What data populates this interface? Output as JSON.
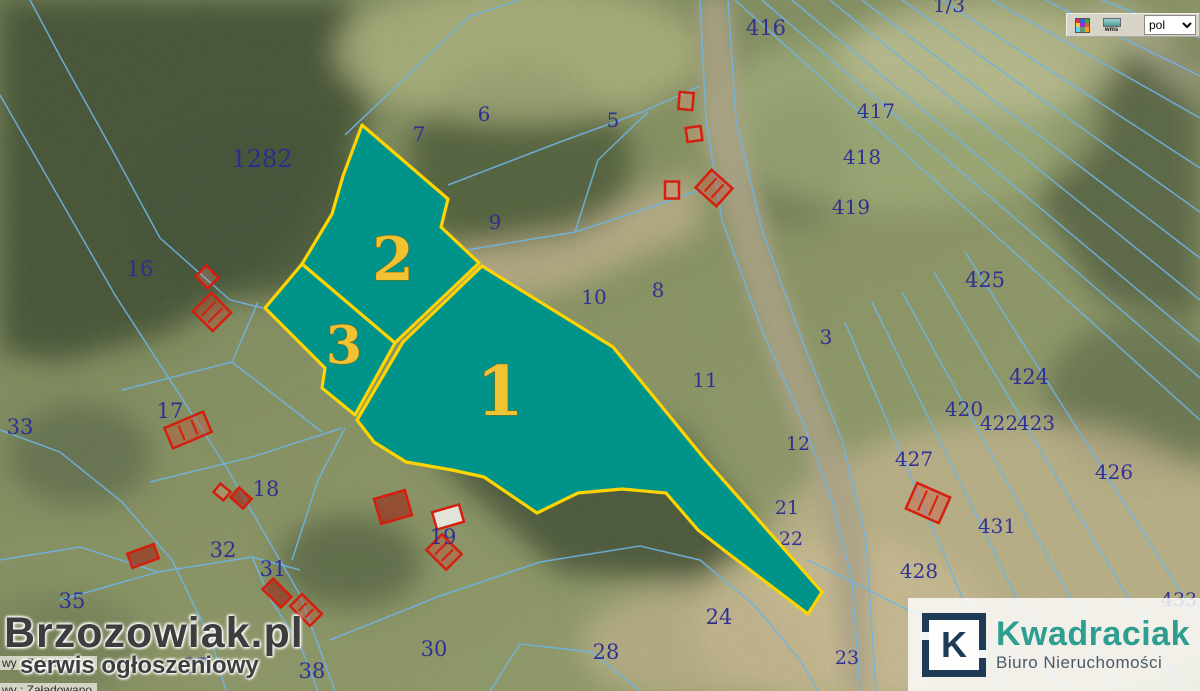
{
  "toolbar": {
    "legend_icon": "legend-grid-icon",
    "wms_icon": "wms-layers-icon",
    "wms_label": "wms",
    "language_value": "pol"
  },
  "watermark": {
    "site": "Brzozowiak.pl",
    "tagline": "serwis ogłoszeniowy"
  },
  "agency": {
    "initial": "K",
    "name": "Kwadraciak",
    "subtitle": "Biuro Nieruchomości"
  },
  "status_messages": [
    "wy : Załadowano",
    "wy : Załadowano"
  ],
  "colors": {
    "parcel_fill": "#00938a",
    "parcel_border": "#ffd400",
    "parcel_label": "#f1c232",
    "parcel_number": "#2b2b94",
    "cadastral_line": "#6fb4e4",
    "building_outline": "#d41f0f",
    "agency_navy": "#1d3a57",
    "agency_teal": "#2d9e8f"
  },
  "map": {
    "highlighted_parcels": [
      {
        "label": "1",
        "points": "482,266 613,347 703,457 822,592 808,614 725,551 698,530 666,493 622,489 578,493 537,513 484,477 452,470 406,462 374,442 357,420 403,342",
        "lx": 500,
        "ly": 392,
        "ls": 68
      },
      {
        "label": "2",
        "points": "362,125 448,199 441,227 479,263 399,339 395,343 302,264 332,214 343,176",
        "lx": 393,
        "ly": 260,
        "ls": 60
      },
      {
        "label": "3",
        "points": "265,308 302,264 395,343 355,415 322,388 325,368",
        "lx": 344,
        "ly": 346,
        "ls": 52
      }
    ],
    "parcel_numbers": [
      {
        "text": "1282",
        "x": 262,
        "y": 167,
        "s": 24
      },
      {
        "text": "16",
        "x": 140,
        "y": 276,
        "s": 21
      },
      {
        "text": "33",
        "x": 20,
        "y": 434,
        "s": 21
      },
      {
        "text": "17",
        "x": 170,
        "y": 418,
        "s": 21
      },
      {
        "text": "18",
        "x": 266,
        "y": 496,
        "s": 21
      },
      {
        "text": "32",
        "x": 223,
        "y": 557,
        "s": 21
      },
      {
        "text": "31",
        "x": 273,
        "y": 576,
        "s": 21
      },
      {
        "text": "35",
        "x": 72,
        "y": 608,
        "s": 21
      },
      {
        "text": "37",
        "x": 196,
        "y": 673,
        "s": 21
      },
      {
        "text": "38",
        "x": 312,
        "y": 678,
        "s": 21
      },
      {
        "text": "30",
        "x": 434,
        "y": 656,
        "s": 21
      },
      {
        "text": "19",
        "x": 443,
        "y": 544,
        "s": 21
      },
      {
        "text": "28",
        "x": 606,
        "y": 659,
        "s": 21
      },
      {
        "text": "24",
        "x": 719,
        "y": 624,
        "s": 21
      },
      {
        "text": "23",
        "x": 847,
        "y": 664,
        "s": 19
      },
      {
        "text": "7",
        "x": 419,
        "y": 141,
        "s": 20
      },
      {
        "text": "6",
        "x": 484,
        "y": 121,
        "s": 20
      },
      {
        "text": "5",
        "x": 613,
        "y": 127,
        "s": 20
      },
      {
        "text": "9",
        "x": 495,
        "y": 229,
        "s": 20
      },
      {
        "text": "10",
        "x": 594,
        "y": 304,
        "s": 20
      },
      {
        "text": "8",
        "x": 658,
        "y": 297,
        "s": 20
      },
      {
        "text": "3",
        "x": 826,
        "y": 344,
        "s": 20
      },
      {
        "text": "11",
        "x": 705,
        "y": 387,
        "s": 20
      },
      {
        "text": "12",
        "x": 798,
        "y": 450,
        "s": 19
      },
      {
        "text": "21",
        "x": 787,
        "y": 514,
        "s": 19
      },
      {
        "text": "22",
        "x": 791,
        "y": 545,
        "s": 19
      },
      {
        "text": "416",
        "x": 766,
        "y": 35,
        "s": 21
      },
      {
        "text": "1/3",
        "x": 949,
        "y": 12,
        "s": 20
      },
      {
        "text": "417",
        "x": 876,
        "y": 118,
        "s": 20
      },
      {
        "text": "418",
        "x": 862,
        "y": 164,
        "s": 20
      },
      {
        "text": "419",
        "x": 851,
        "y": 214,
        "s": 20
      },
      {
        "text": "425",
        "x": 985,
        "y": 287,
        "s": 21
      },
      {
        "text": "424",
        "x": 1029,
        "y": 384,
        "s": 21
      },
      {
        "text": "420",
        "x": 964,
        "y": 416,
        "s": 20
      },
      {
        "text": "422",
        "x": 999,
        "y": 430,
        "s": 20
      },
      {
        "text": "423",
        "x": 1036,
        "y": 430,
        "s": 20
      },
      {
        "text": "426",
        "x": 1114,
        "y": 479,
        "s": 20
      },
      {
        "text": "427",
        "x": 914,
        "y": 466,
        "s": 20
      },
      {
        "text": "431",
        "x": 997,
        "y": 533,
        "s": 20
      },
      {
        "text": "428",
        "x": 919,
        "y": 578,
        "s": 20
      },
      {
        "text": "433",
        "x": 1179,
        "y": 606,
        "s": 19
      }
    ],
    "buildings": [
      {
        "x": 686,
        "y": 101,
        "w": 14,
        "h": 17,
        "r": 5,
        "style": "outline"
      },
      {
        "x": 694,
        "y": 134,
        "w": 15,
        "h": 14,
        "r": -8,
        "style": "outline"
      },
      {
        "x": 672,
        "y": 190,
        "w": 14,
        "h": 17,
        "r": 0,
        "style": "outline"
      },
      {
        "x": 714,
        "y": 188,
        "w": 28,
        "h": 24,
        "r": 42,
        "style": "hatch"
      },
      {
        "x": 207,
        "y": 277,
        "w": 17,
        "h": 15,
        "r": 45,
        "style": "outline"
      },
      {
        "x": 212,
        "y": 312,
        "w": 28,
        "h": 26,
        "r": 45,
        "style": "hatch"
      },
      {
        "x": 188,
        "y": 430,
        "w": 42,
        "h": 22,
        "r": -23,
        "style": "hatch"
      },
      {
        "x": 222,
        "y": 492,
        "w": 13,
        "h": 11,
        "r": 40,
        "style": "outline"
      },
      {
        "x": 241,
        "y": 498,
        "w": 17,
        "h": 13,
        "r": 42,
        "style": "dark"
      },
      {
        "x": 393,
        "y": 507,
        "w": 32,
        "h": 26,
        "r": -16,
        "style": "dark"
      },
      {
        "x": 448,
        "y": 517,
        "w": 28,
        "h": 18,
        "r": -16,
        "style": "light"
      },
      {
        "x": 444,
        "y": 552,
        "w": 28,
        "h": 22,
        "r": 45,
        "style": "hatch"
      },
      {
        "x": 277,
        "y": 593,
        "w": 26,
        "h": 15,
        "r": 45,
        "style": "dark"
      },
      {
        "x": 306,
        "y": 610,
        "w": 28,
        "h": 17,
        "r": 45,
        "style": "hatch"
      },
      {
        "x": 143,
        "y": 556,
        "w": 28,
        "h": 15,
        "r": -20,
        "style": "dark"
      },
      {
        "x": 928,
        "y": 503,
        "w": 36,
        "h": 28,
        "r": 24,
        "style": "hatch"
      }
    ]
  }
}
